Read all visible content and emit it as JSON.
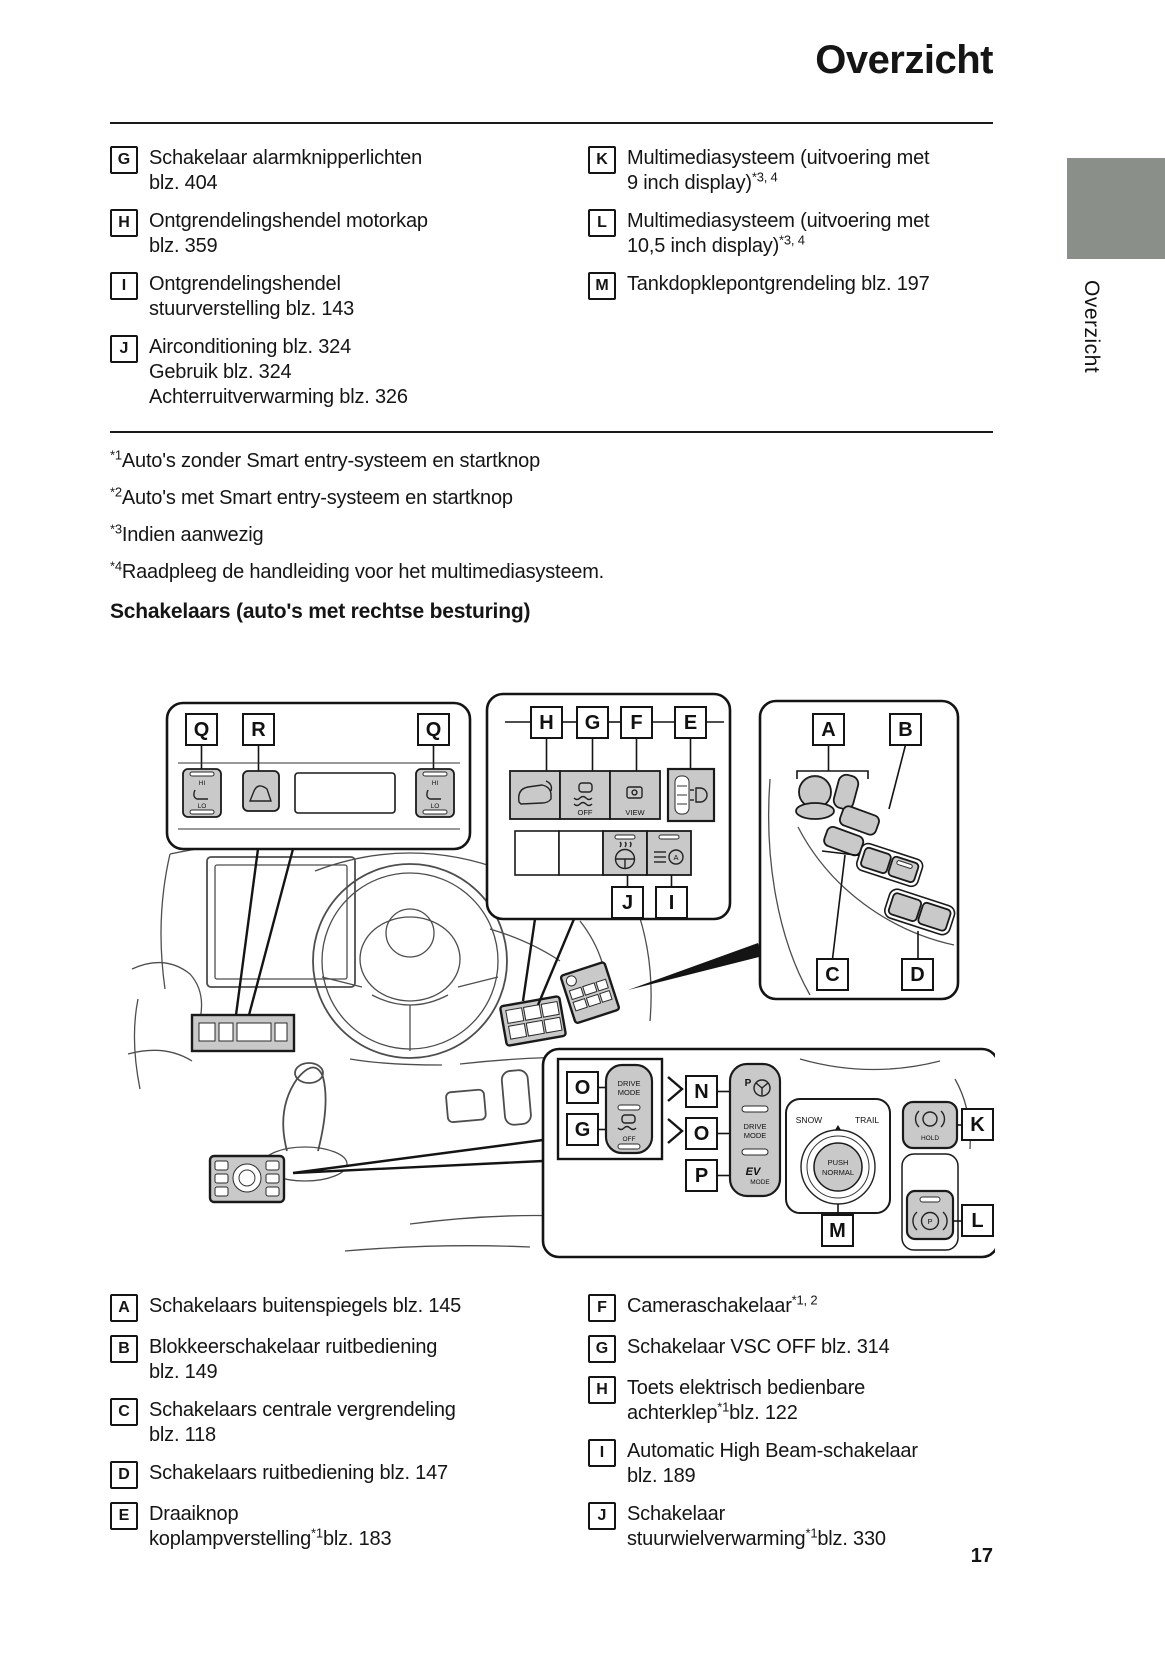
{
  "page": {
    "title": "Overzicht",
    "number": "17",
    "tab_label": "Overzicht",
    "tab_color": "#8b8f8a",
    "button_gray": "#c9c9c9"
  },
  "overview_list": {
    "left": [
      {
        "label": "G",
        "segments": [
          {
            "t": "Schakelaar alarmknipperlichten"
          },
          {
            "br": true
          },
          {
            "t": "blz. 404"
          }
        ]
      },
      {
        "label": "H",
        "segments": [
          {
            "t": "Ontgrendelingshendel motorkap"
          },
          {
            "br": true
          },
          {
            "t": "blz. 359"
          }
        ]
      },
      {
        "label": "I",
        "segments": [
          {
            "t": "Ontgrendelingshendel"
          },
          {
            "br": true
          },
          {
            "t": "stuurverstelling blz. 143"
          }
        ]
      },
      {
        "label": "J",
        "segments": [
          {
            "t": "Airconditioning blz. 324"
          },
          {
            "br": true
          },
          {
            "t": "Gebruik blz. 324"
          },
          {
            "br": true
          },
          {
            "t": "Achterruitverwarming blz. 326"
          }
        ]
      }
    ],
    "right": [
      {
        "label": "K",
        "segments": [
          {
            "t": "Multimediasysteem (uitvoering met"
          },
          {
            "br": true
          },
          {
            "t": "9 inch display)"
          },
          {
            "sup": "*3, 4"
          }
        ]
      },
      {
        "label": "L",
        "segments": [
          {
            "t": "Multimediasysteem (uitvoering met"
          },
          {
            "br": true
          },
          {
            "t": "10,5 inch display)"
          },
          {
            "sup": "*3, 4"
          }
        ]
      },
      {
        "label": "M",
        "segments": [
          {
            "t": "Tankdopklepontgrendeling blz. 197"
          }
        ]
      }
    ]
  },
  "footnotes": [
    {
      "sup": "*1",
      "t": "Auto's zonder Smart entry-systeem en startknop"
    },
    {
      "sup": "*2",
      "t": "Auto's met Smart entry-systeem en startknop"
    },
    {
      "sup": "*3",
      "t": "Indien aanwezig"
    },
    {
      "sup": "*4",
      "t": "Raadpleeg de handleiding voor het multimediasysteem."
    }
  ],
  "section_heading": "Schakelaars (auto's met rechtse besturing)",
  "switch_list": {
    "left": [
      {
        "label": "A",
        "segments": [
          {
            "t": "Schakelaars buitenspiegels blz. 145"
          }
        ]
      },
      {
        "label": "B",
        "segments": [
          {
            "t": "Blokkeerschakelaar ruitbediening"
          },
          {
            "br": true
          },
          {
            "t": "blz. 149"
          }
        ]
      },
      {
        "label": "C",
        "segments": [
          {
            "t": "Schakelaars centrale vergrendeling"
          },
          {
            "br": true
          },
          {
            "t": "blz. 118"
          }
        ]
      },
      {
        "label": "D",
        "segments": [
          {
            "t": "Schakelaars ruitbediening blz. 147"
          }
        ]
      },
      {
        "label": "E",
        "segments": [
          {
            "t": "Draaiknop"
          },
          {
            "br": true
          },
          {
            "t": "koplampverstelling"
          },
          {
            "sup": "*1"
          },
          {
            "t": "blz. 183"
          }
        ]
      }
    ],
    "right": [
      {
        "label": "F",
        "segments": [
          {
            "t": "Cameraschakelaar"
          },
          {
            "sup": "*1, 2"
          }
        ]
      },
      {
        "label": "G",
        "segments": [
          {
            "t": "Schakelaar VSC OFF blz. 314"
          }
        ]
      },
      {
        "label": "H",
        "segments": [
          {
            "t": "Toets elektrisch bedienbare"
          },
          {
            "br": true
          },
          {
            "t": "achterklep"
          },
          {
            "sup": "*1"
          },
          {
            "t": "blz. 122"
          }
        ]
      },
      {
        "label": "I",
        "segments": [
          {
            "t": "Automatic High Beam-schakelaar"
          },
          {
            "br": true
          },
          {
            "t": "blz. 189"
          }
        ]
      },
      {
        "label": "J",
        "segments": [
          {
            "t": "Schakelaar"
          },
          {
            "br": true
          },
          {
            "t": "stuurwielverwarming"
          },
          {
            "sup": "*1"
          },
          {
            "t": "blz. 330"
          }
        ]
      }
    ]
  },
  "diagram": {
    "callouts": {
      "q1": "Q",
      "r1": "R",
      "q2": "Q",
      "h": "H",
      "g_panel": "G",
      "f": "F",
      "e": "E",
      "j": "J",
      "i": "I",
      "a": "A",
      "b": "B",
      "c": "C",
      "d": "D",
      "o_drive": "O",
      "g_vsc": "G",
      "n": "N",
      "o_col": "O",
      "p_col": "P",
      "m": "M",
      "k": "K",
      "l": "L"
    },
    "texts": {
      "hi_left": "HI",
      "lo_left": "LO",
      "hi_right": "HI",
      "lo_right": "LO",
      "vsc_off": "OFF",
      "view": "VIEW",
      "ahb_a": "A",
      "drive_small_1": "DRIVE",
      "drive_small_2": "MODE",
      "vsc_off_small": "OFF",
      "p_steer": "P",
      "drive_col_1": "DRIVE",
      "drive_col_2": "MODE",
      "ev": "EV",
      "ev_mode": "MODE",
      "snow": "SNOW",
      "trail": "TRAIL",
      "push": "PUSH",
      "normal": "NORMAL",
      "hold": "HOLD",
      "p_brake": "P"
    }
  }
}
